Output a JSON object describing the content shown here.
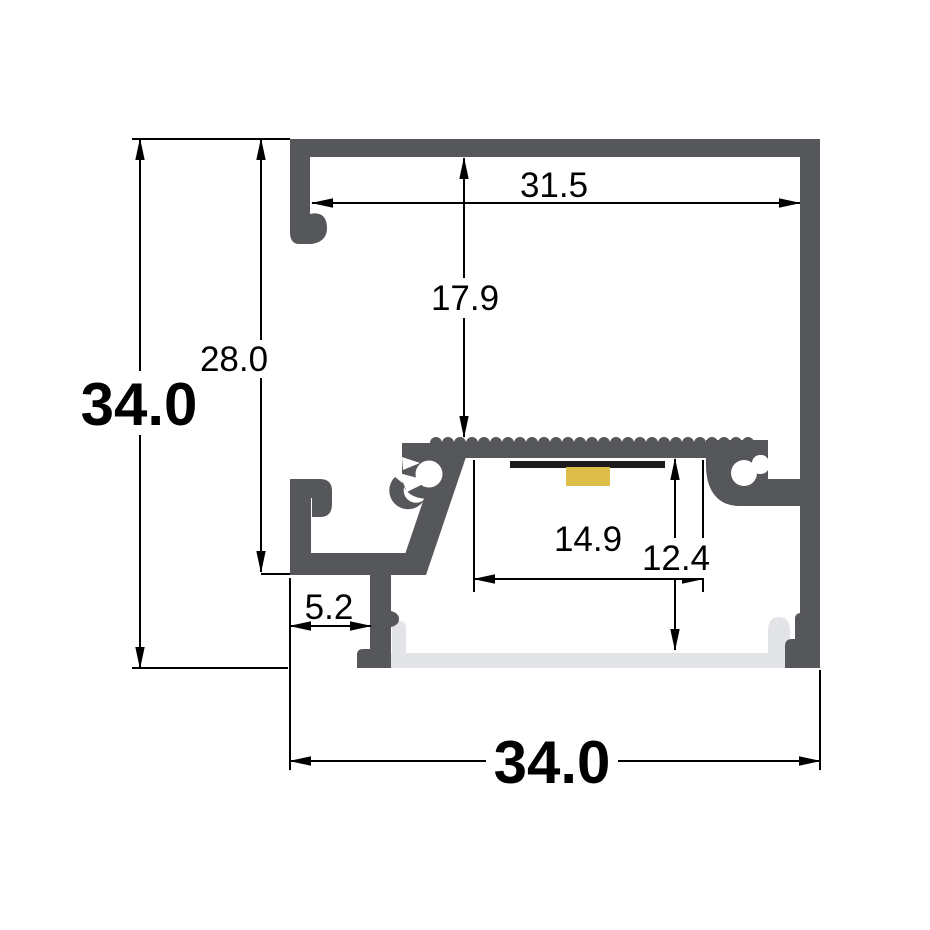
{
  "drawing": {
    "title": "LED aluminium profile cross-section",
    "dimensions": {
      "overall_height": "34.0",
      "mount_depth": "28.0",
      "inner_top_width": "31.5",
      "platform_depth": "17.9",
      "led_slot_width": "14.9",
      "cavity_depth": "12.4",
      "foot_offset": "5.2",
      "overall_width": "34.0"
    }
  },
  "colors": {
    "profile": "#56575a",
    "diffuser": "#e3e4e7",
    "pcb": "#1b1b1b",
    "led_chip": "#dcbe49",
    "line": "#000000",
    "background": "#ffffff"
  }
}
